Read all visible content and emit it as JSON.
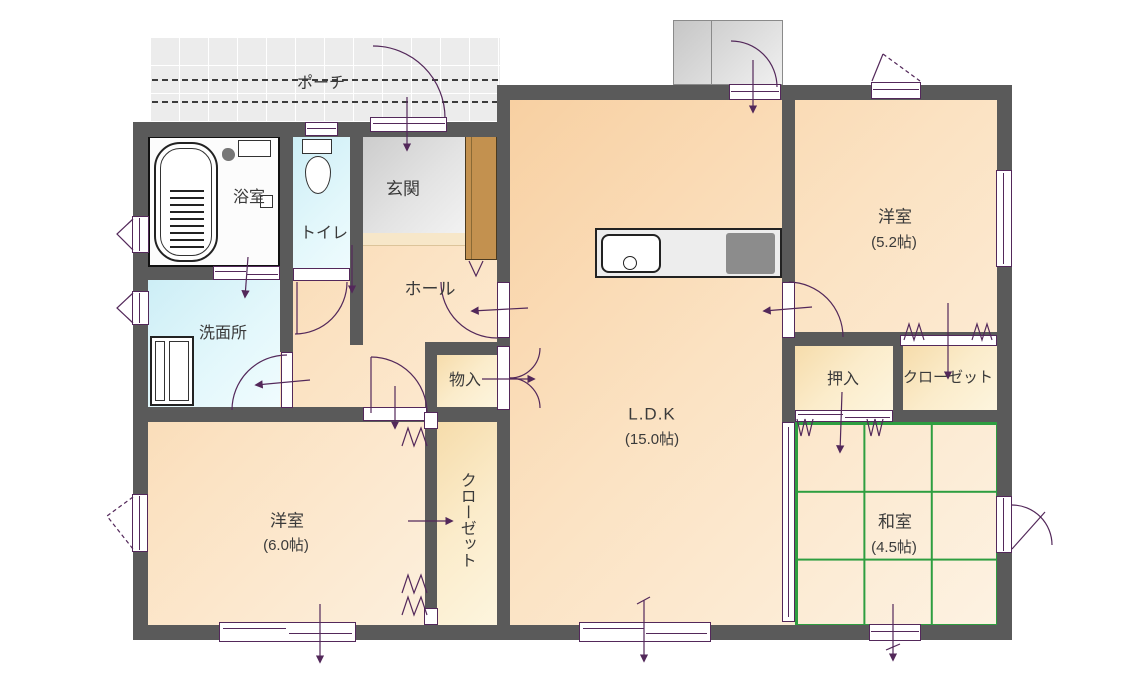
{
  "meta": {
    "type": "floor-plan",
    "floor_area_labels": [
      "15.0帖",
      "5.2帖",
      "4.5帖",
      "6.0帖"
    ]
  },
  "rooms": {
    "porch": {
      "label": "ポーチ"
    },
    "bathroom": {
      "label": "浴室"
    },
    "toilet": {
      "label": "トイレ"
    },
    "entrance": {
      "label": "玄関"
    },
    "hall": {
      "label": "ホール"
    },
    "washroom": {
      "label": "洗面所"
    },
    "storage": {
      "label": "物入"
    },
    "ldk": {
      "label": "L.D.K",
      "size": "(15.0帖)"
    },
    "western_5_2": {
      "label": "洋室",
      "size": "(5.2帖)"
    },
    "oshiire": {
      "label": "押入"
    },
    "closet_right": {
      "label": "クローゼット"
    },
    "closet_middle": {
      "label": "クローゼット"
    },
    "japanese_4_5": {
      "label": "和室",
      "size": "(4.5帖)"
    },
    "western_6_0": {
      "label": "洋室",
      "size": "(6.0帖)"
    }
  },
  "colors": {
    "wall": "#5a5a5a",
    "room_floor": "#fbdcb6",
    "closet_floor": "#f9e4ba",
    "tatami_green": "#bdeebd",
    "tatami_line": "#2e9e40",
    "wet_area_cyan": "#d6f2f8",
    "entrance_gray": "#dcdcdc",
    "porch_gray": "#ececec",
    "fixture_line_purple": "#53285a",
    "shoe_cabinet_brown": "#c3914f"
  }
}
